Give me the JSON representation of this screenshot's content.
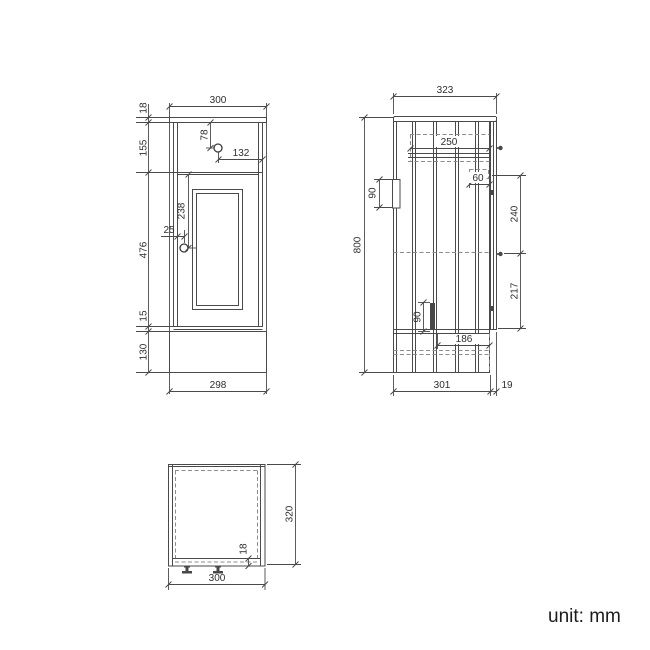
{
  "unit_label": "unit: mm",
  "front_view": {
    "dims": {
      "top_width": "300",
      "counter_thickness": "18",
      "upper_section_height": "155",
      "drawer_knob_from_top": "78",
      "drawer_knob_from_right": "132",
      "door_knob_from_top": "238",
      "door_knob_inset": "25",
      "door_section_height": "476",
      "bottom_gap": "15",
      "plinth_height": "130",
      "base_width": "298"
    }
  },
  "side_view": {
    "dims": {
      "top_depth": "323",
      "overall_height": "800",
      "drawer_depth": "250",
      "hanger_height": "90",
      "runner_bracket": "60",
      "upper_clearance": "240",
      "lower_clearance": "217",
      "foot_bracket_height": "90",
      "runner_length": "186",
      "body_depth": "301",
      "door_thickness": "19"
    }
  },
  "plan_view": {
    "dims": {
      "overall_depth": "320",
      "panel_thickness": "18",
      "overall_width": "300"
    }
  }
}
